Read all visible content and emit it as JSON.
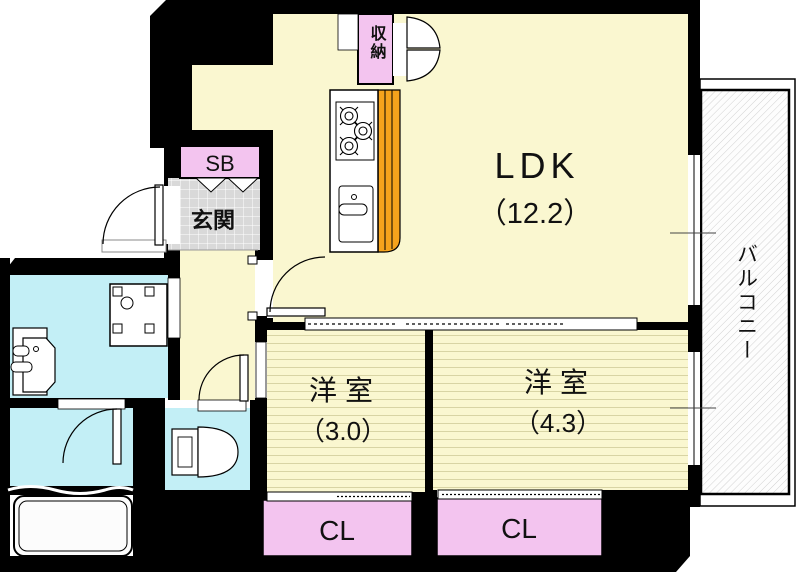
{
  "plan_title": "apartment-floorplan",
  "colors": {
    "wall": "#000000",
    "ldk_floor": "#FAF7D0",
    "bedroom_stripe": "#D8D4A4",
    "closet_pink": "#F3C4EF",
    "wet_area_blue": "#C3EFF6",
    "entrance_tile": "#D9D9D9",
    "kitchen_orange": "#F5A31C",
    "fixture_white": "#FFFFFF"
  },
  "rooms": {
    "ldk": {
      "label": "LDK",
      "size": "（12.2）"
    },
    "bedroom_small": {
      "label": "洋室",
      "size": "（3.0）"
    },
    "bedroom_large": {
      "label": "洋室",
      "size": "（4.3）"
    },
    "entrance": {
      "label": "玄関"
    },
    "shoebox": {
      "label": "SB"
    },
    "storage": {
      "label": "収納"
    },
    "balcony": {
      "label": "バルコニー"
    },
    "closet_left": {
      "label": "CL"
    },
    "closet_right": {
      "label": "CL"
    }
  },
  "fixtures": {
    "kitchen": "kitchen-counter-stove-sink",
    "bathtub": "bathtub",
    "toilet": "toilet",
    "washer_pan": "washing-machine-pan",
    "vanity": "wash-basin"
  }
}
